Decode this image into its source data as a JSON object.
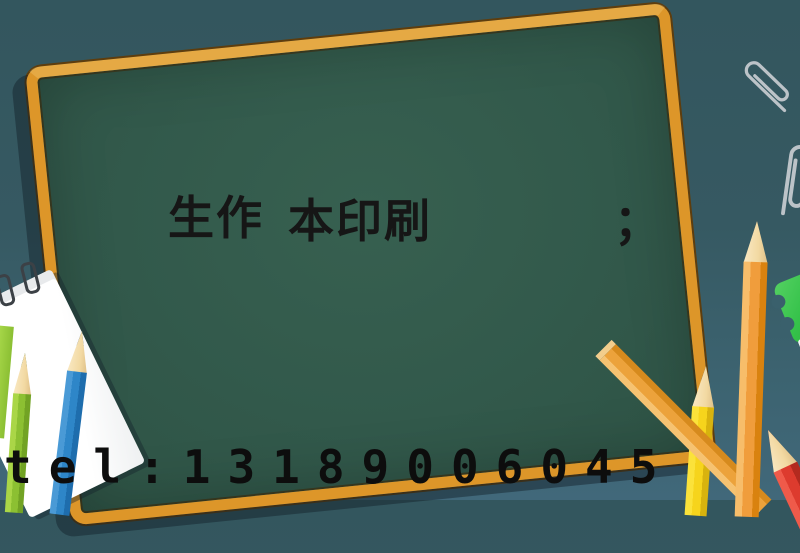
{
  "scene": {
    "description": "Chalkboard printing-service advertisement illustration",
    "background": {
      "top_color": "#33565E",
      "bottom_color": "#41687A"
    }
  },
  "board": {
    "surface_color": "#32594B",
    "frame_color": "#DD9629",
    "title": {
      "part1": "生作",
      "part2": "本印刷",
      "punctuation": "；",
      "color": "#161616"
    }
  },
  "contact": {
    "tel": "tel:13189006045",
    "color": "#0D0D0D"
  },
  "decorations": {
    "paperclips": {
      "count": 2,
      "color": "#BCC3C8"
    },
    "notepad": {
      "paper_color": "#FFFFFF",
      "ring_color": "#3C4146"
    },
    "pencils": [
      {
        "name": "green-pencil",
        "body_color": "#8CC032"
      },
      {
        "name": "blue-pencil",
        "body_color": "#2E86C8"
      },
      {
        "name": "yellow-pencil",
        "body_color": "#F6D41C"
      },
      {
        "name": "orange-pencil",
        "body_color": "#F09D3C"
      },
      {
        "name": "orange-stick",
        "body_color": "#ECA23B"
      },
      {
        "name": "red-pencil",
        "body_color": "#DD3B2E"
      }
    ],
    "sharpener": {
      "body_color": "#35C24A",
      "blade_color": "#E9ECEE"
    }
  }
}
